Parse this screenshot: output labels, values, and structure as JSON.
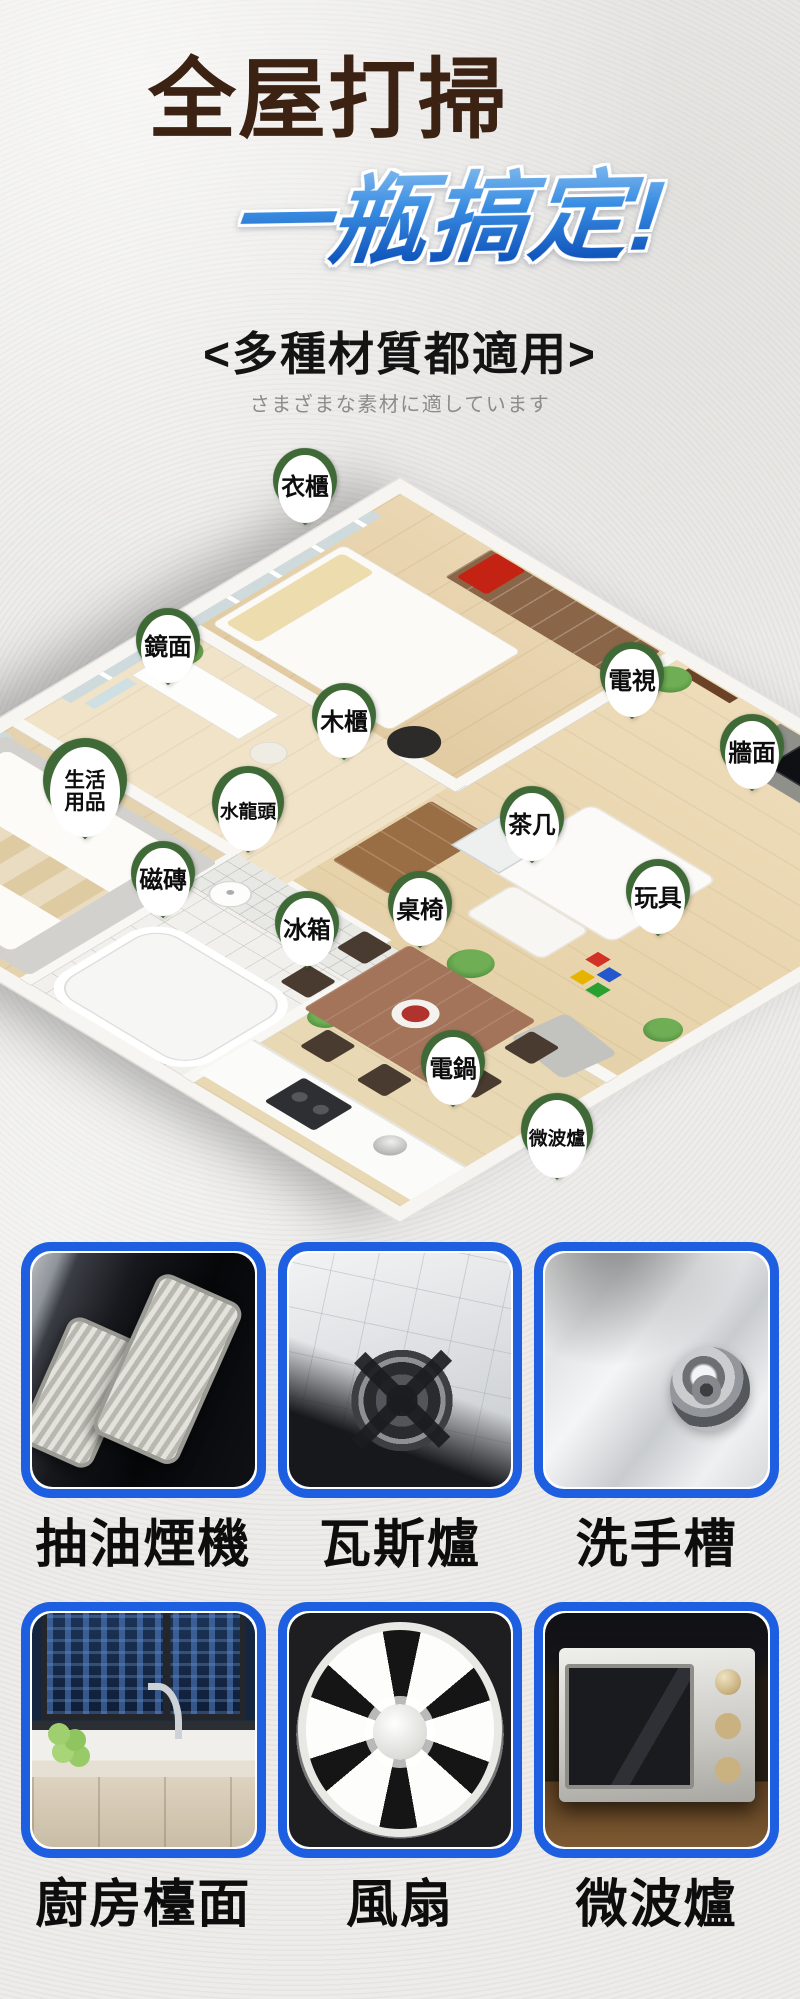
{
  "header": {
    "title": "全屋打掃",
    "subtitle": "一瓶搞定!",
    "tagline": "<多種材質都適用>",
    "tagline_jp": "さまざまな素材に適しています"
  },
  "colors": {
    "background": "#edecea",
    "title_brown": "#3b2212",
    "subtitle_blue_top": "#7db8ee",
    "subtitle_blue_bottom": "#1257bd",
    "pin_green": "#3f6936",
    "card_border_blue": "#1d5fe0"
  },
  "room_map": {
    "pins": [
      {
        "label": "衣櫃",
        "x": 305,
        "y": 78
      },
      {
        "label": "鏡面",
        "x": 168,
        "y": 238
      },
      {
        "label": "電視",
        "x": 632,
        "y": 272
      },
      {
        "label": "木櫃",
        "x": 344,
        "y": 313
      },
      {
        "label": "牆面",
        "x": 752,
        "y": 344
      },
      {
        "label": "生活\n用品",
        "x": 85,
        "y": 378
      },
      {
        "label": "水龍頭",
        "x": 248,
        "y": 400
      },
      {
        "label": "茶几",
        "x": 532,
        "y": 416
      },
      {
        "label": "磁磚",
        "x": 163,
        "y": 471
      },
      {
        "label": "玩具",
        "x": 658,
        "y": 489
      },
      {
        "label": "桌椅",
        "x": 420,
        "y": 501
      },
      {
        "label": "冰箱",
        "x": 307,
        "y": 521
      },
      {
        "label": "電鍋",
        "x": 453,
        "y": 660
      },
      {
        "label": "微波爐",
        "x": 557,
        "y": 727
      }
    ]
  },
  "gallery": {
    "items": [
      {
        "label": "抽油煙機",
        "art": "range-hood"
      },
      {
        "label": "瓦斯爐",
        "art": "gas-stove"
      },
      {
        "label": "洗手槽",
        "art": "sink"
      },
      {
        "label": "廚房檯面",
        "art": "kitchen-counter"
      },
      {
        "label": "風扇",
        "art": "fan"
      },
      {
        "label": "微波爐",
        "art": "microwave-oven"
      }
    ]
  }
}
